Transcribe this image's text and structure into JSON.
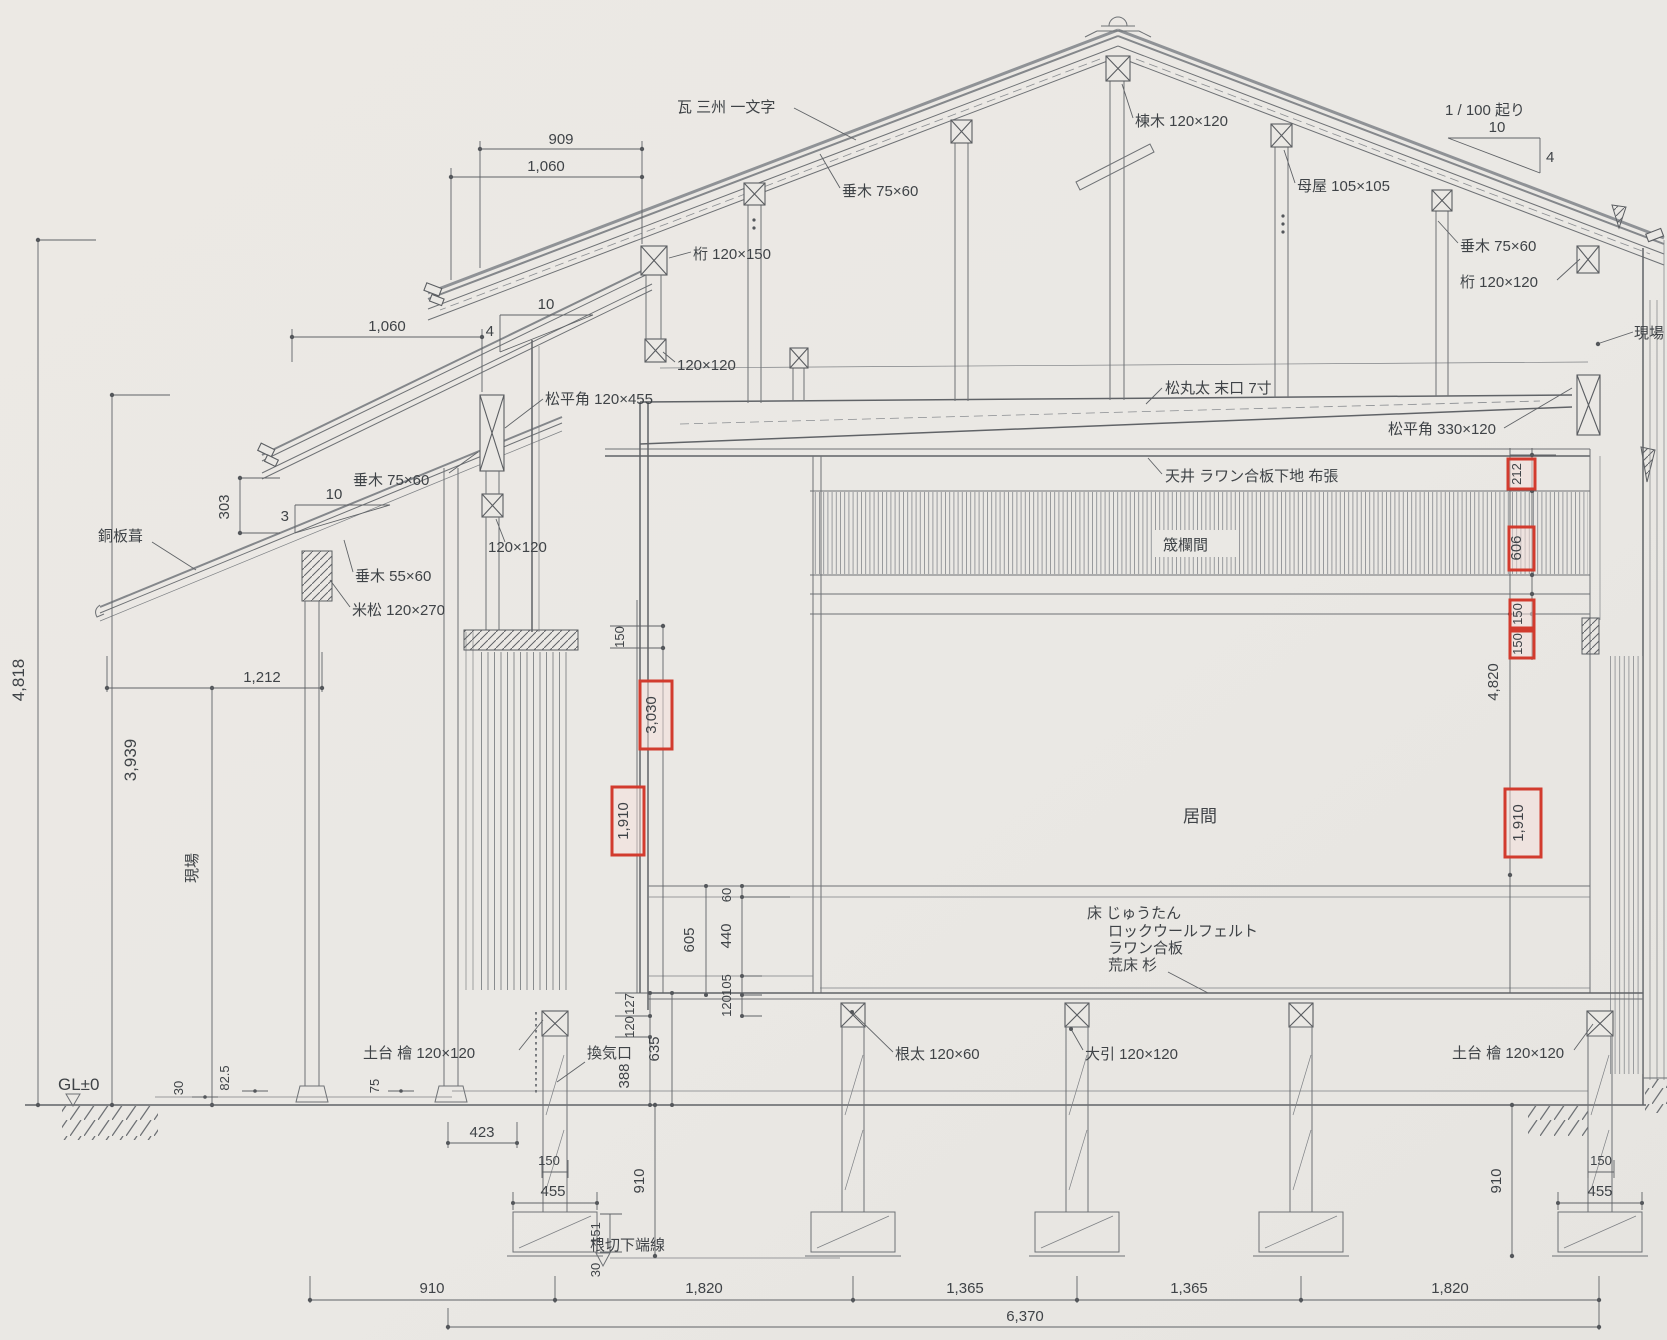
{
  "labels": {
    "kawara": "瓦 三州 一文字",
    "munagi": "棟木 120×120",
    "taruki_a": "垂木 75×60",
    "taruki_b": "垂木 75×60",
    "taruki_c": "垂木 75×60",
    "taruki_d": "垂木 55×60",
    "moya": "母屋 105×105",
    "keta_a": "桁 120×150",
    "keta_b": "桁 120×120",
    "sq120_a": "120×120",
    "sq120_b": "120×120",
    "okori": "1 / 100 起り",
    "genba_r": "現場",
    "genba_l": "現場",
    "hirakaku_a": "松平角 120×455",
    "hirakaku_b": "松平角 330×120",
    "douban": "銅板葺",
    "beimatsu": "米松 120×270",
    "marutai": "松丸太 末口 7寸",
    "tenjo": "天井 ラワン合板下地 布張",
    "ranma": "筬欄間",
    "ima": "居間",
    "floor_layers": [
      "床 じゅうたん",
      "ロックウールフェルト",
      "ラワン合板",
      "荒床 杉"
    ],
    "neda": "根太 120×60",
    "obiki": "大引 120×120",
    "dodai_l": "土台 檜 120×120",
    "dodai_r": "土台 檜 120×120",
    "kanki": "換気口",
    "gl": "GL±0",
    "nekiri": "根切下端線"
  },
  "slopes": {
    "left_upper": {
      "run": "10",
      "rise": "4"
    },
    "porch": {
      "run": "10",
      "rise": "3"
    },
    "right": {
      "run": "10",
      "rise": "4"
    }
  },
  "dims": {
    "d909": "909",
    "d1060_top": "1,060",
    "d1060_left": "1,060",
    "d303": "303",
    "d4818": "4,818",
    "d3939": "3,939",
    "d1212": "1,212",
    "d150_top": "150",
    "d605": "605",
    "d440": "440",
    "d60": "60",
    "d105": "105",
    "d120_r": "120",
    "d127": "127",
    "d120_l": "120",
    "d635": "635",
    "d388": "388",
    "d30_gl": "30",
    "d825": "82.5",
    "d75": "75",
    "d423": "423",
    "d150_fl": "150",
    "d455_fl": "455",
    "d910_l": "910",
    "d151": "151",
    "d30_f": "30",
    "d910_b": "910",
    "d1820_a": "1,820",
    "d1365_a": "1,365",
    "d1365_b": "1,365",
    "d1820_b": "1,820",
    "d6370": "6,370",
    "d4820": "4,820",
    "d150_fr": "150",
    "d455_fr": "455",
    "d910_r": "910"
  },
  "highlights": {
    "h212": "212",
    "h606": "606",
    "h150_a": "150",
    "h150_b": "150",
    "h3030": "3,030",
    "h1910_l": "1,910",
    "h1910_r": "1,910"
  },
  "colors": {
    "paper": "#eae8e4",
    "line": "#6e7175",
    "text": "#3f4347",
    "highlight_border": "#d23b2e",
    "highlight_fill": "#f6dfdb"
  }
}
